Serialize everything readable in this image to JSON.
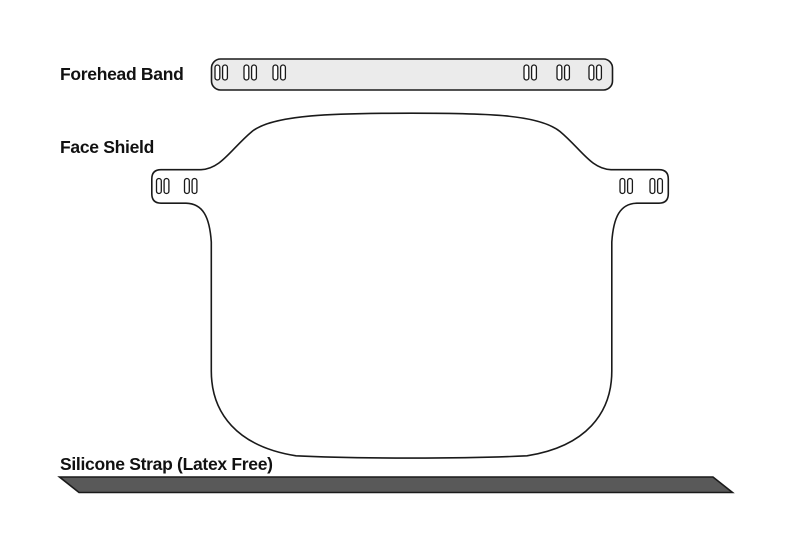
{
  "title": "Face shield components diagram",
  "labels": {
    "forehead_band": "Forehead Band",
    "face_shield": "Face Shield",
    "silicone_strap": "Silicone Strap (Latex Free)"
  },
  "colors": {
    "background": "#ffffff",
    "outline": "#1a1a1a",
    "label_text": "#111111",
    "band_fill": "#ebebeb",
    "slot_fill": "#ffffff",
    "strap_fill": "#595959"
  }
}
